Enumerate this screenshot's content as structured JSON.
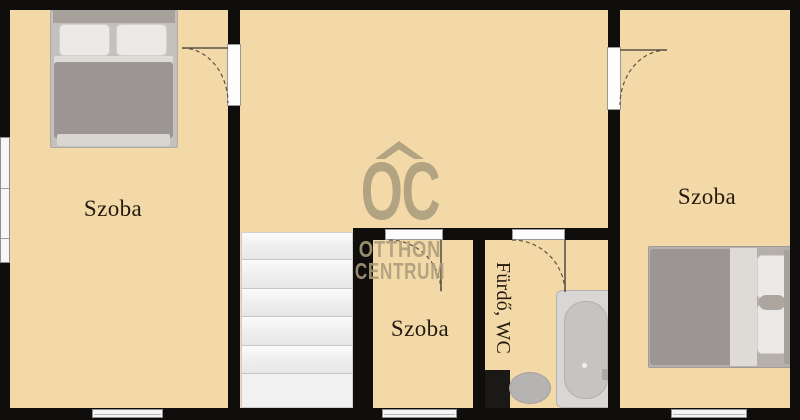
{
  "plan": {
    "rooms": {
      "left": {
        "label": "Szoba"
      },
      "right": {
        "label": "Szoba"
      },
      "middle_bottom": {
        "label": "Szoba"
      },
      "bathroom": {
        "label": "Fürdő, WC"
      }
    },
    "watermark": {
      "logo": "OC",
      "line1": "OTTHON",
      "line2": "CENTRUM"
    },
    "stairs": {
      "step_count": 6
    },
    "colors": {
      "floor": "#f4d9a8",
      "wall": "#0f0e0c",
      "watermark": "#a99d7d",
      "label_text": "#241a10"
    }
  }
}
